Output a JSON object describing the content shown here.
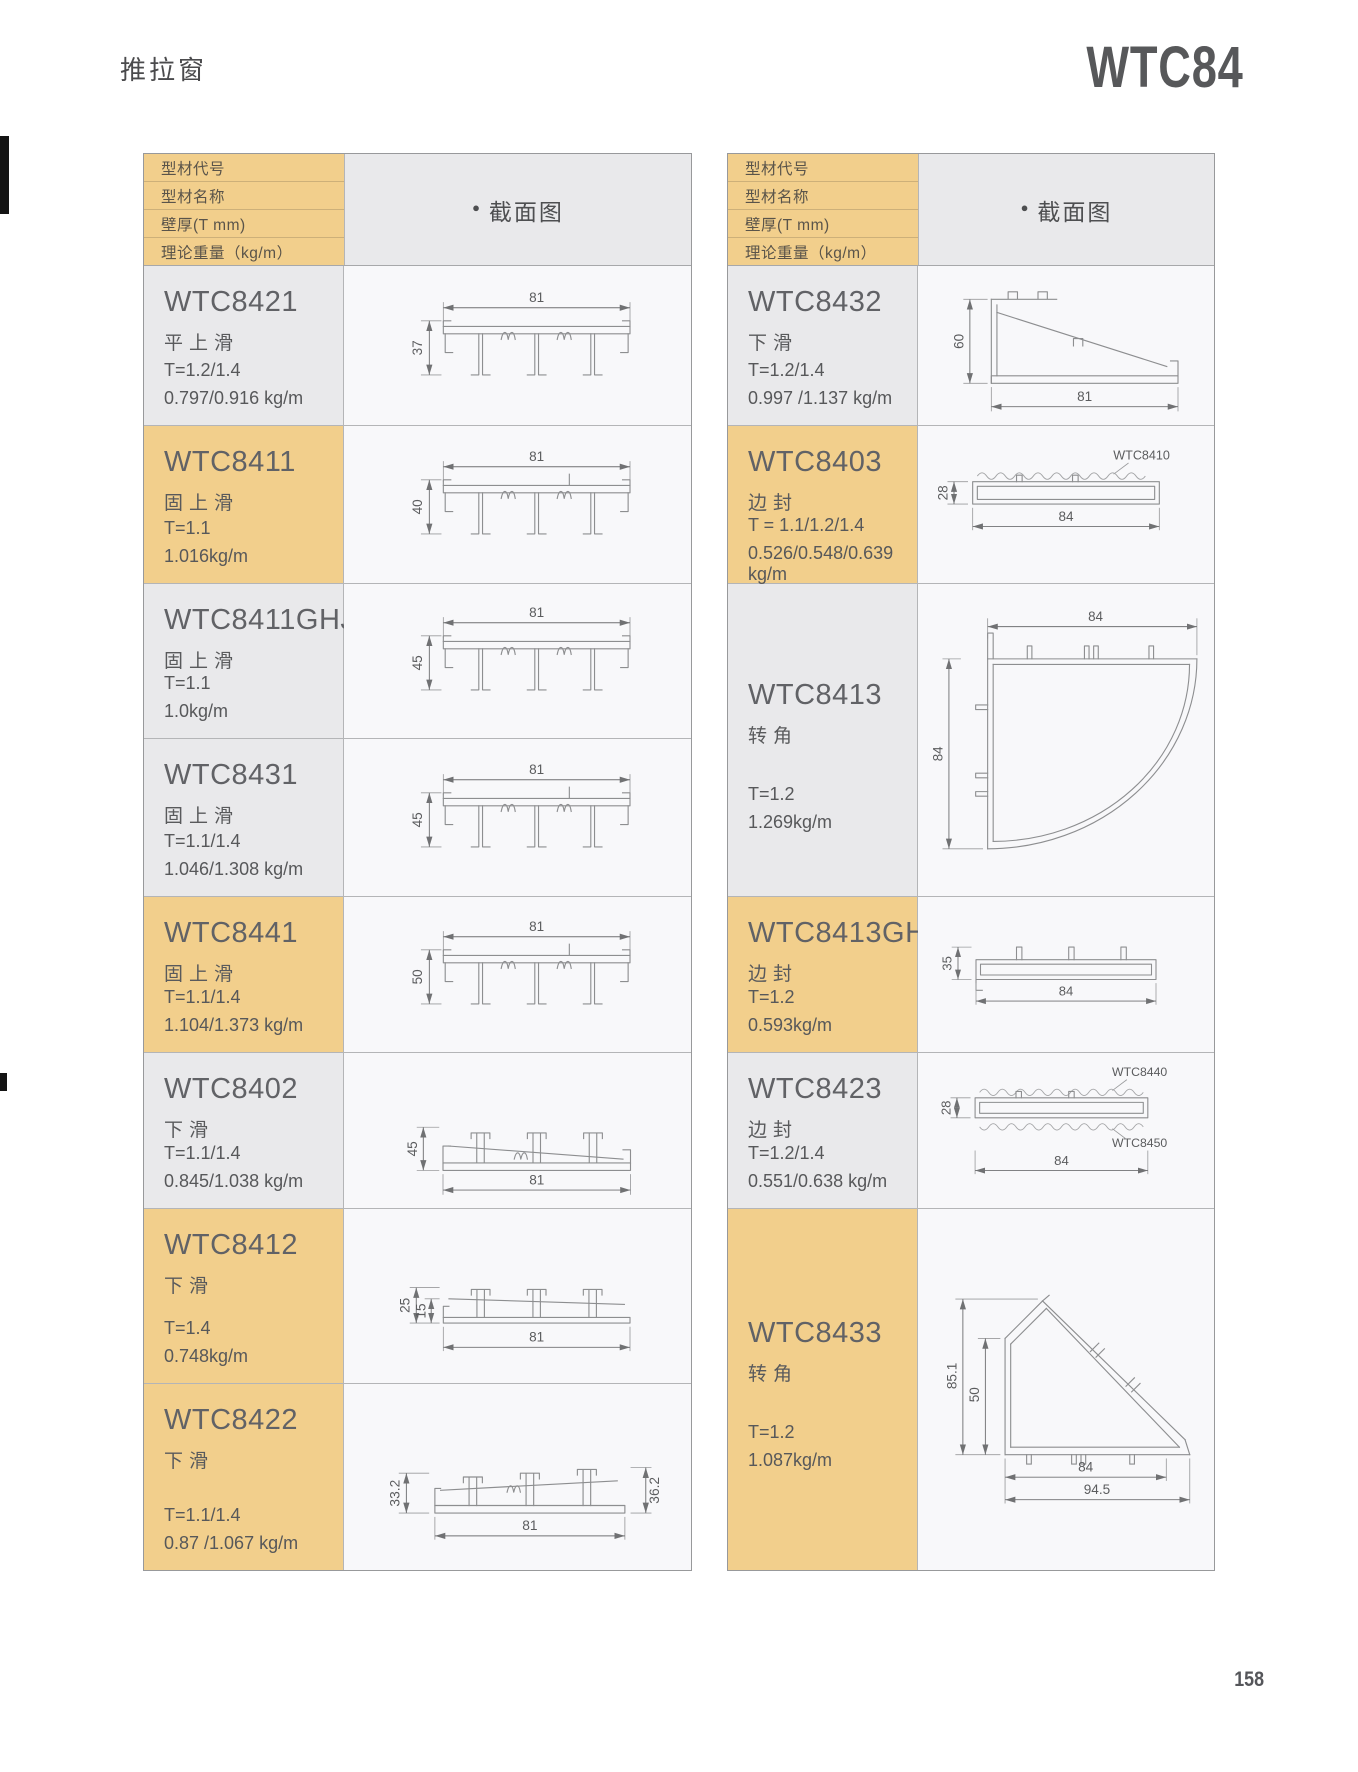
{
  "page": {
    "category": "推拉窗",
    "series": "WTC84",
    "page_number": "158"
  },
  "table_header": {
    "row_labels": [
      "型材代号",
      "型材名称",
      "壁厚(T mm)",
      "理论重量（kg/m）"
    ],
    "section_bullet": "●",
    "section_label": "截面图"
  },
  "colors": {
    "highlight_yellow": "#f2cf8c",
    "cell_gray": "#e9e9eb"
  },
  "left_table": {
    "rows": [
      {
        "code": "WTC8421",
        "name": "平上滑",
        "thickness": "T=1.2/1.4",
        "weight": "0.797/0.916 kg/m",
        "row_color": "gray",
        "dims": {
          "width": "81",
          "height": "37"
        }
      },
      {
        "code": "WTC8411",
        "name": "固上滑",
        "thickness": "T=1.1",
        "weight": "1.016kg/m",
        "row_color": "yellow",
        "dims": {
          "width": "81",
          "height": "40"
        }
      },
      {
        "code": "WTC8411GHJ",
        "name": "固上滑",
        "thickness": "T=1.1",
        "weight": "1.0kg/m",
        "row_color": "gray",
        "dims": {
          "width": "81",
          "height": "45"
        }
      },
      {
        "code": "WTC8431",
        "name": "固上滑",
        "thickness": "T=1.1/1.4",
        "weight": "1.046/1.308 kg/m",
        "row_color": "gray",
        "dims": {
          "width": "81",
          "height": "45"
        }
      },
      {
        "code": "WTC8441",
        "name": "固上滑",
        "thickness": "T=1.1/1.4",
        "weight": "1.104/1.373 kg/m",
        "row_color": "yellow",
        "dims": {
          "width": "81",
          "height": "50"
        }
      },
      {
        "code": "WTC8402",
        "name": "下滑",
        "thickness": "T=1.1/1.4",
        "weight": "0.845/1.038 kg/m",
        "row_color": "gray",
        "dims": {
          "width": "81",
          "height": "45"
        }
      },
      {
        "code": "WTC8412",
        "name": "下滑",
        "thickness": "T=1.4",
        "weight": "0.748kg/m",
        "row_color": "yellow",
        "dims": {
          "width": "81",
          "height_outer": "25",
          "height_inner": "15"
        }
      },
      {
        "code": "WTC8422",
        "name": "下滑",
        "thickness": "T=1.1/1.4",
        "weight": "0.87 /1.067 kg/m",
        "row_color": "yellow",
        "dims": {
          "width": "81",
          "height_left": "33.2",
          "height_right": "36.2"
        }
      }
    ]
  },
  "right_table": {
    "rows": [
      {
        "code": "WTC8432",
        "name": "下滑",
        "thickness": "T=1.2/1.4",
        "weight": "0.997 /1.137 kg/m",
        "row_color": "gray",
        "dims": {
          "width": "81",
          "height": "60"
        }
      },
      {
        "code": "WTC8403",
        "name": "边封",
        "thickness": "T = 1.1/1.2/1.4",
        "weight": "0.526/0.548/0.639 kg/m",
        "row_color": "yellow",
        "dims": {
          "width": "84",
          "height": "28",
          "mate_top": "WTC8410"
        }
      },
      {
        "code": "WTC8413",
        "name": "转角",
        "thickness": "T=1.2",
        "weight": "1.269kg/m",
        "row_color": "gray",
        "dims": {
          "width": "84",
          "height": "84"
        }
      },
      {
        "code": "WTC8413GHJ",
        "name": "边封",
        "thickness": "T=1.2",
        "weight": "0.593kg/m",
        "row_color": "yellow",
        "dims": {
          "width": "84",
          "height": "35"
        }
      },
      {
        "code": "WTC8423",
        "name": "边封",
        "thickness": "T=1.2/1.4",
        "weight": "0.551/0.638 kg/m",
        "row_color": "gray",
        "dims": {
          "width": "84",
          "height": "28",
          "mate_top": "WTC8440",
          "mate_bottom": "WTC8450"
        }
      },
      {
        "code": "WTC8433",
        "name": "转角",
        "thickness": "T=1.2",
        "weight": "1.087kg/m",
        "row_color": "yellow",
        "dims": {
          "height_outer": "85.1",
          "height_inner": "50",
          "width_inner": "84",
          "width_outer": "94.5"
        }
      }
    ]
  }
}
